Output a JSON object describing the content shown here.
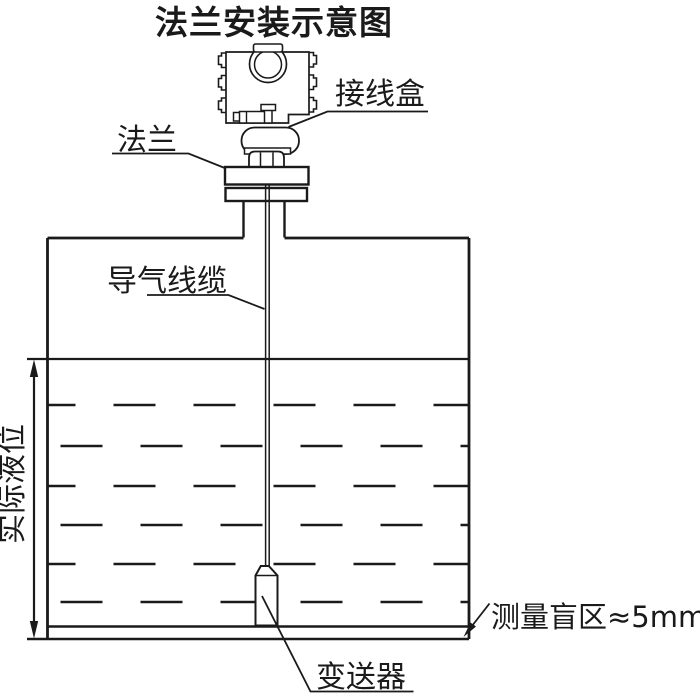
{
  "title": "法兰安装示意图",
  "labels": {
    "junction_box": "接线盒",
    "flange": "法兰",
    "vent_cable": "导气线缆",
    "actual_level": "实际液位",
    "transmitter": "变送器",
    "blind_zone": "测量盲区≈5mm"
  },
  "colors": {
    "line": "#1a1a1a",
    "background": "#ffffff"
  }
}
